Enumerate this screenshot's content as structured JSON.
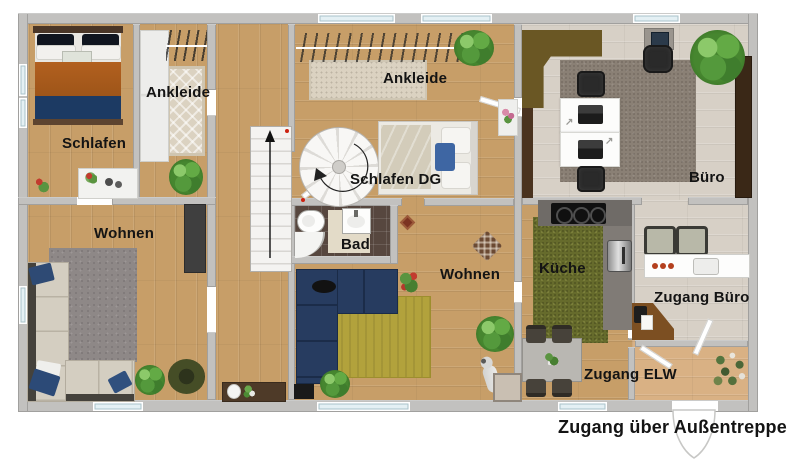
{
  "rooms": {
    "schlafen": {
      "label": "Schlafen"
    },
    "ankleide_left": {
      "label": "Ankleide"
    },
    "ankleide_center": {
      "label": "Ankleide"
    },
    "schlafen_dg": {
      "label": "Schlafen DG"
    },
    "bad": {
      "label": "Bad"
    },
    "wohnen_left": {
      "label": "Wohnen"
    },
    "wohnen_center": {
      "label": "Wohnen"
    },
    "buero": {
      "label": "Büro"
    },
    "kueche": {
      "label": "Küche"
    },
    "zugang_buero": {
      "label": "Zugang Büro"
    },
    "zugang_elw": {
      "label": "Zugang ELW"
    }
  },
  "annotations": {
    "entrance_note": "Zugang über Außentreppe"
  },
  "colors": {
    "wall": "#c2c1bf",
    "window": "#e4f0f4",
    "wood": "#c79e68",
    "wood_light": "#d9b184",
    "floor_gray": "#d7d0c6",
    "tile": "#57473f",
    "rug_gray": "#8e8887",
    "rug_olive": "#b2a23c",
    "rug_green": "#666b2c",
    "rug_office": "#8a8075",
    "rug_beige": "#dbd2c1",
    "sofa_beige": "#d4cec1",
    "sofa_navy": "#273c60",
    "accent_red": "#cc2211",
    "label": "#141414"
  }
}
